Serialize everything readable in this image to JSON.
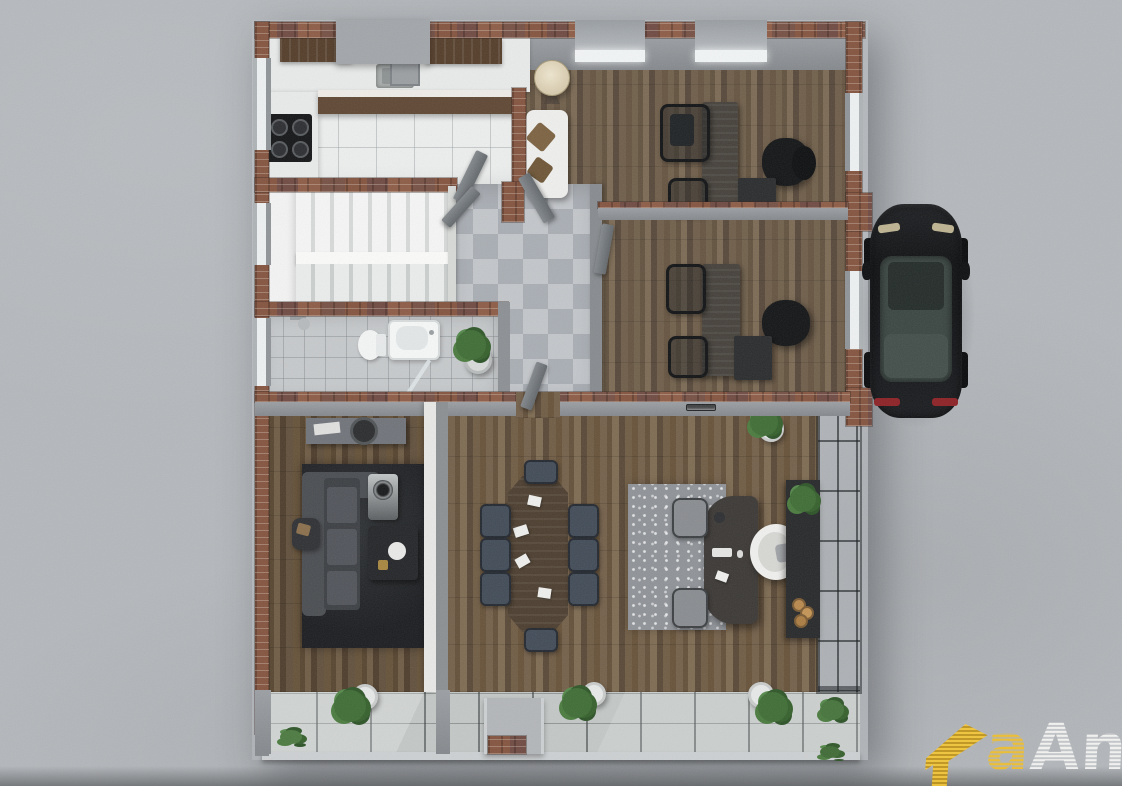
{
  "scene": {
    "title": "Top-down 3D architectural render of a single-storey office floor plan",
    "view": "orthographic top-down cutaway (roof removed)",
    "surroundings": "gray concrete paving with black sedan parked at right facade"
  },
  "palette": {
    "concrete": "#b4b8bc",
    "brick_wall": "#7d5243",
    "interior_wall": "#8e9296",
    "wood_floor_office": "#6d5a46",
    "wood_floor_main": "#6b563e",
    "wood_floor_lounge": "#5f4c3a",
    "kitchen_tile": "#edefee",
    "checker_light": "#c3c6ca",
    "checker_dark": "#a9aeb4",
    "bath_tile": "#c6c9cb",
    "terrace_glass_deck": "#c3c8c6",
    "marble_stairs": "#f5f6f5",
    "rug_dark": "#1f2124",
    "rug_exec": "#8f9398",
    "conference_chair": "#414b57",
    "car_body": "#141619",
    "logo_yellow": "#e9b427",
    "logo_white": "#f2f2f2"
  },
  "building": {
    "rooms": [
      {
        "name": "kitchen",
        "floor": "white tile",
        "features": [
          "upper wood cabinets",
          "counter with sink",
          "island counter",
          "black 4-burner stove",
          "left window"
        ]
      },
      {
        "name": "reception-nook",
        "floor": "wood",
        "features": [
          "white bench sofa",
          "two brown pillows",
          "tripod floor lamp"
        ]
      },
      {
        "name": "office-1",
        "floor": "wood plank",
        "features": [
          "two skylights",
          "desk",
          "black task chair",
          "black executive chair",
          "side chair",
          "low cabinet",
          "right window"
        ]
      },
      {
        "name": "office-2",
        "floor": "wood plank",
        "features": [
          "desk",
          "two guest chairs",
          "black executive chair",
          "low cabinet",
          "right window",
          "swing door"
        ]
      },
      {
        "name": "staircase",
        "floor": "white marble",
        "features": [
          "U-shaped double flight",
          "side landing",
          "left window"
        ]
      },
      {
        "name": "foyer",
        "floor": "gray checkerboard tile",
        "features": [
          "potted plant",
          "open swing doors"
        ]
      },
      {
        "name": "bathroom",
        "floor": "gray tile",
        "features": [
          "bathtub",
          "toilet",
          "shower head",
          "glass screen",
          "left window"
        ]
      },
      {
        "name": "tv-lounge",
        "floor": "wood plank",
        "features": [
          "console sideboard with tray and bowl",
          "L-shaped dark sofa",
          "armchair",
          "coffee table with bowl",
          "media unit",
          "dark shag rug"
        ]
      },
      {
        "name": "open-office",
        "floor": "wood plank",
        "features": [
          "8-seat conference table with papers",
          "curved executive desk",
          "white executive chair",
          "two gray guest chairs",
          "patterned gray rug",
          "credenza with plant and wood decor",
          "glass curtain wall",
          "potted plant",
          "recessed wall light"
        ]
      }
    ]
  },
  "exterior": {
    "car": {
      "type": "sedan",
      "color": "black",
      "details": [
        "glass roof with sunroof",
        "headlights",
        "red taillights",
        "side mirrors"
      ],
      "position": "parked along right wall, nose up"
    },
    "terrace": {
      "deck": "glass panels",
      "features": [
        "entry ramp",
        "three potted shrubs",
        "ground planting",
        "brick paver patch"
      ]
    },
    "walls": "red brick perimeter with window openings and pilasters"
  },
  "watermark": {
    "arrow_color": "#e9b427",
    "text_yellow": "a",
    "text_white": "Ani",
    "texture": "hatched brick-style lettering, cropped at bottom edge"
  }
}
